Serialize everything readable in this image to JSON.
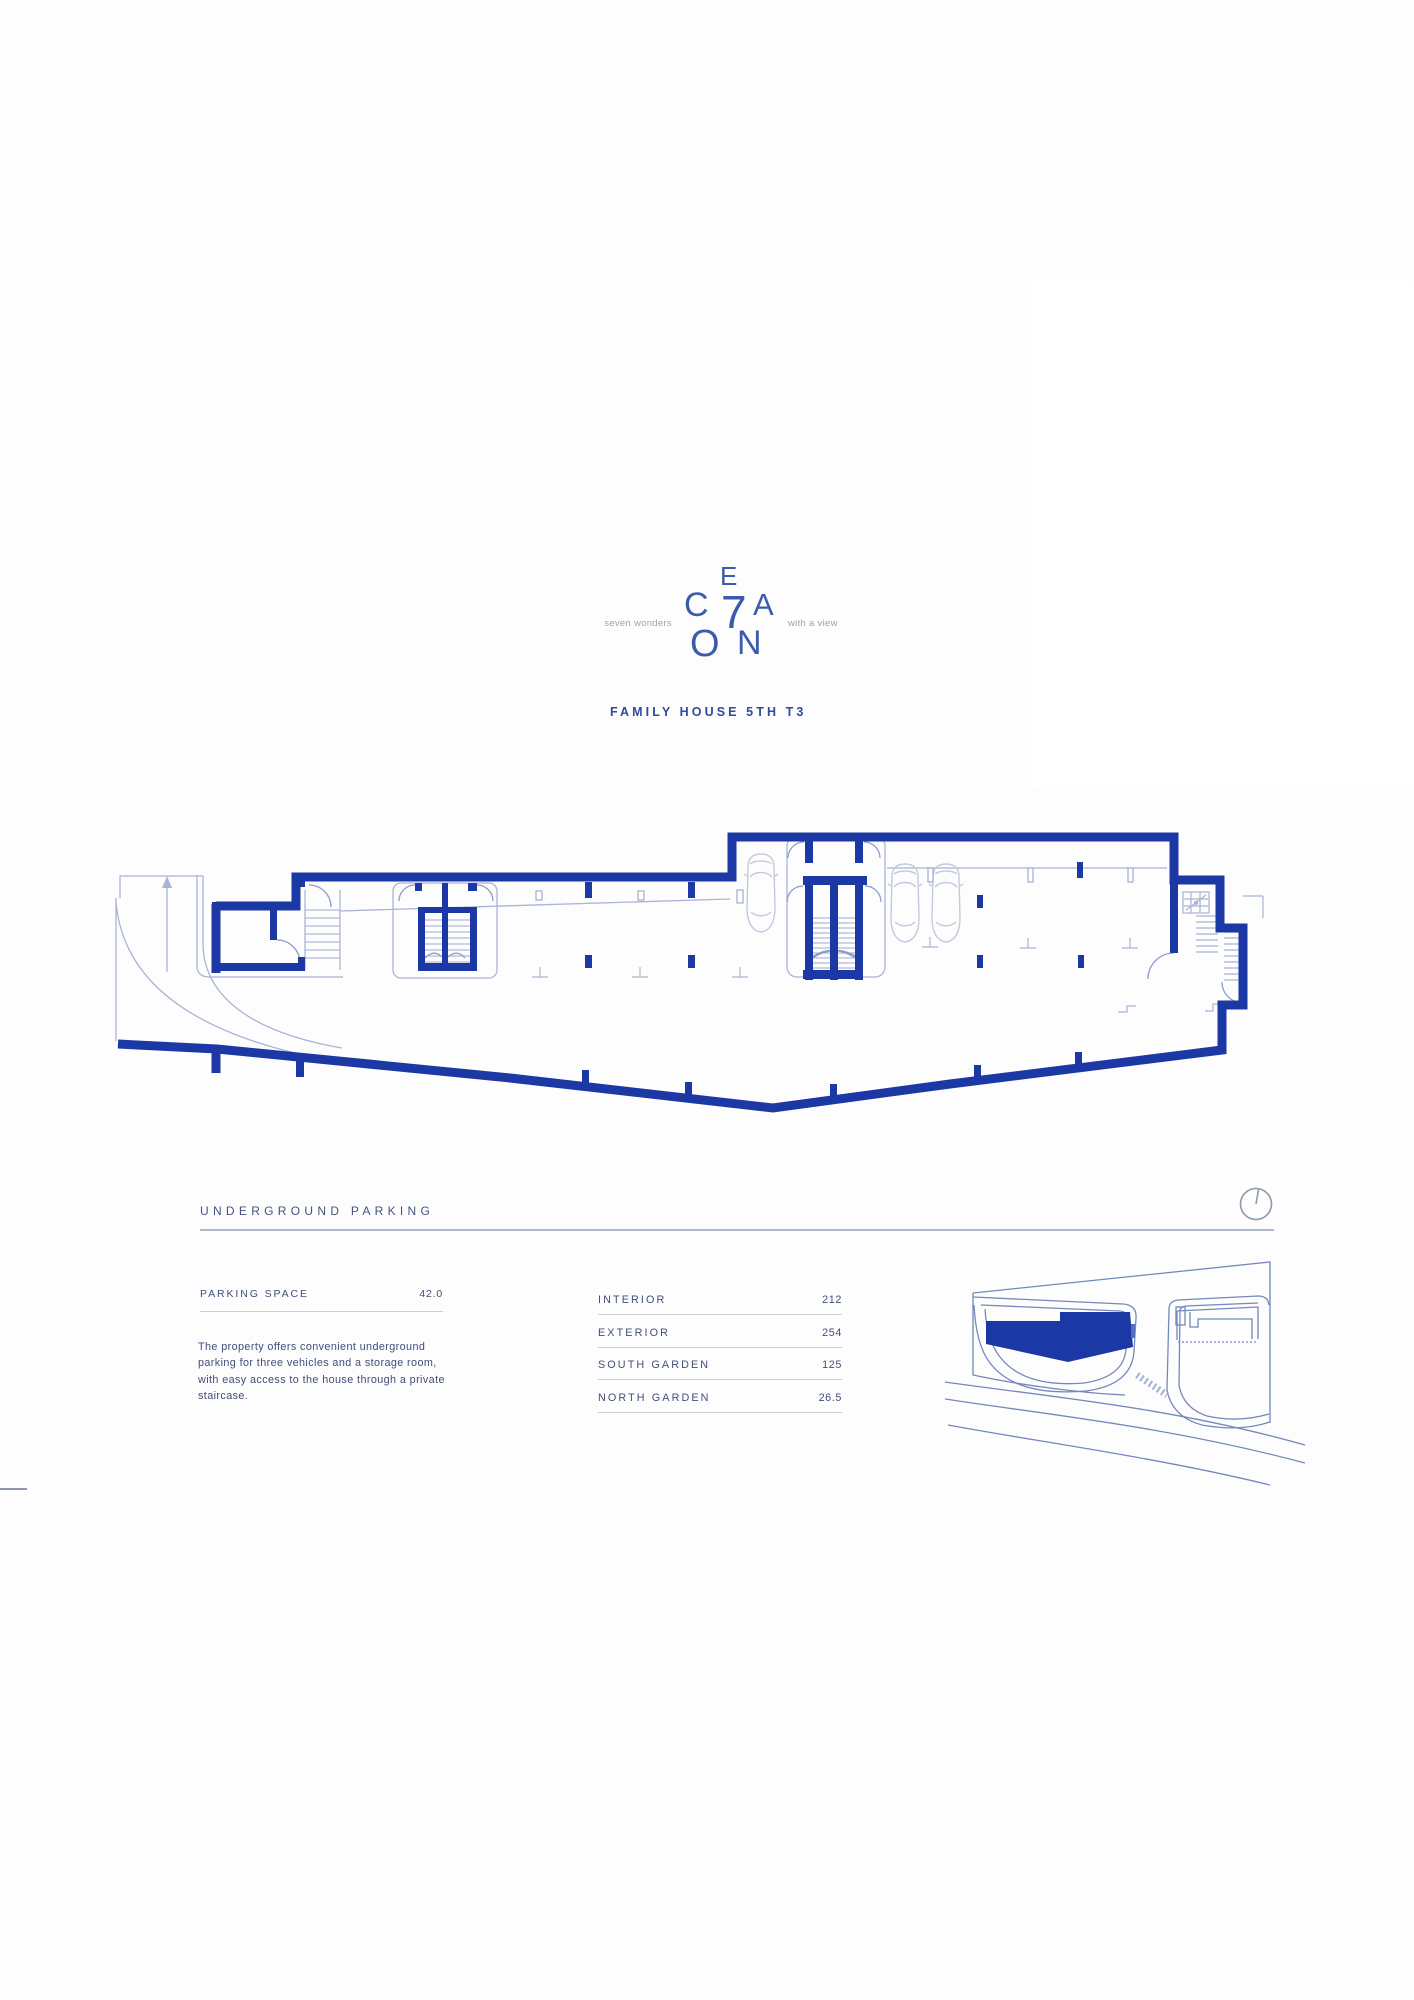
{
  "brand": {
    "letters": [
      "C",
      "E",
      "7",
      "A",
      "O",
      "N"
    ],
    "tagline_left": "seven wonders",
    "tagline_right": "with a view",
    "title": "FAMILY HOUSE 5TH T3"
  },
  "section": {
    "heading": "UNDERGROUND PARKING",
    "compass_icon": "north-indicator-icon"
  },
  "stats": {
    "parking_label": "PARKING SPACE",
    "parking_value": "42.0",
    "description": "The property offers convenient underground parking for three vehicles and a storage room, with easy access to the house through a private staircase."
  },
  "areas": {
    "rows": [
      {
        "label": "INTERIOR",
        "value": "212"
      },
      {
        "label": "EXTERIOR",
        "value": "254"
      },
      {
        "label": "SOUTH GARDEN",
        "value": "125"
      },
      {
        "label": "NORTH GARDEN",
        "value": "26.5"
      }
    ]
  },
  "drawings": {
    "floor_plan": "underground-parking-floor-plan",
    "site_map": "site-location-minimap-highlighted-unit"
  },
  "colors": {
    "wall_blue": "#1b38a4",
    "light_line": "#a9b4d6",
    "text_slate": "#414e79",
    "logo_blue": "#3c5cab",
    "title_blue": "#2e4b9f"
  }
}
